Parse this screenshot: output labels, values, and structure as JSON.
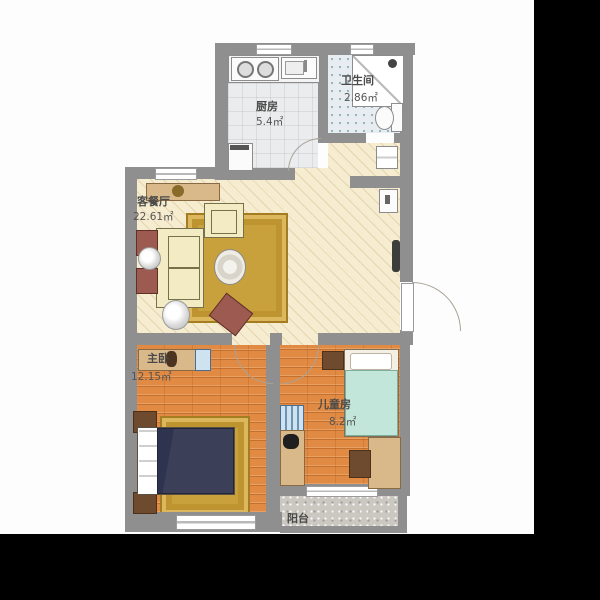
{
  "plan": {
    "rooms": {
      "kitchen": {
        "name": "厨房",
        "area": "5.4㎡"
      },
      "bathroom": {
        "name": "卫生间",
        "area": "2.86㎡"
      },
      "living": {
        "name": "客餐厅",
        "area": "22.61㎡"
      },
      "master": {
        "name": "主卧",
        "area": "12.15㎡"
      },
      "kids": {
        "name": "儿童房",
        "area": "8.2㎡"
      },
      "balcony": {
        "name": "阳台"
      }
    },
    "colors": {
      "wall": "#8f8f90",
      "living_floor": "#f6ecd0",
      "wood_floor": "#e08a43",
      "kitchen_floor": "#ebecee",
      "bath_floor": "#e7edf0",
      "balcony_floor": "#cbc8c1",
      "rug": "#c9a13c",
      "letterbox": "#000000"
    }
  }
}
